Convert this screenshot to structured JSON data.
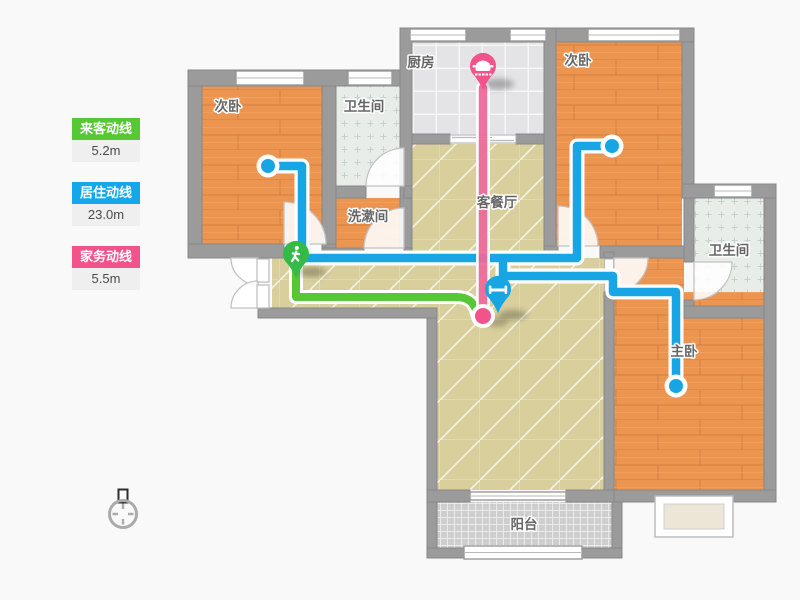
{
  "legend": {
    "items": [
      {
        "id": "guest",
        "label": "来客动线",
        "value": "5.2m",
        "color": "#57C835"
      },
      {
        "id": "resident",
        "label": "居住动线",
        "value": "23.0m",
        "color": "#14A7E9"
      },
      {
        "id": "chore",
        "label": "家务动线",
        "value": "5.5m",
        "color": "#F2538A"
      }
    ]
  },
  "rooms": {
    "bedroom_left": {
      "label": "次卧",
      "floor": "wood"
    },
    "bath_top": {
      "label": "卫生间",
      "floor": "tile"
    },
    "kitchen": {
      "label": "厨房",
      "floor": "tile"
    },
    "bedroom_right": {
      "label": "次卧",
      "floor": "wood"
    },
    "living_dining": {
      "label": "客餐厅",
      "floor": "tile"
    },
    "washroom": {
      "label": "洗漱间",
      "floor": "wood"
    },
    "bath_right": {
      "label": "卫生间",
      "floor": "tile"
    },
    "master_bedroom": {
      "label": "主卧",
      "floor": "wood"
    },
    "balcony": {
      "label": "阳台",
      "floor": "mosaic"
    }
  },
  "routes": {
    "guest": {
      "name": "来客动线",
      "length": "5.2m",
      "color": "#57C835",
      "marker_icon": "walking-person",
      "start": "entrance"
    },
    "resident": {
      "name": "居住动线",
      "length": "23.0m",
      "color": "#14A7E9",
      "marker_icon": "bed",
      "start": "living-room"
    },
    "chore": {
      "name": "家务动线",
      "length": "5.5m",
      "color": "#F2538A",
      "marker_icon": "cooking-pot",
      "start": "kitchen"
    }
  },
  "icons": {
    "compass": "north-indicator"
  }
}
